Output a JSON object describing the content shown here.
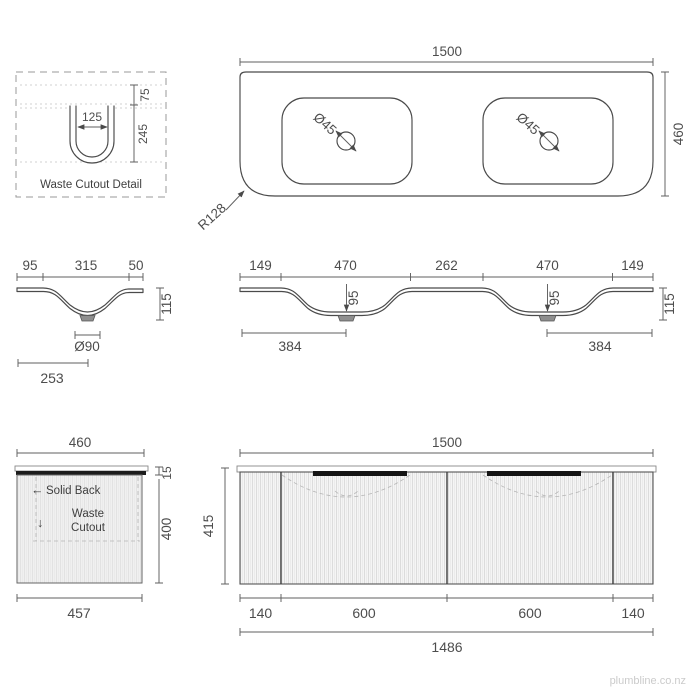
{
  "colors": {
    "line": "#4a4a4a",
    "text": "#4d4d4d",
    "handle": "#141414",
    "watermark": "#cbcbcb"
  },
  "watermark": "plumbline.co.nz",
  "waste_cutout_detail": {
    "title": "Waste Cutout Detail",
    "width": "125",
    "top_offset": "75",
    "depth": "245"
  },
  "benchtop_top_view": {
    "width": "1500",
    "depth": "460",
    "taphole_left": "Ø45",
    "taphole_right": "Ø45",
    "corner_radius": "R128"
  },
  "basin_side_section": {
    "back_offset": "95",
    "bowl_width": "315",
    "front_offset": "50",
    "height": "115",
    "drain_diameter": "Ø90",
    "drain_centre": "253"
  },
  "basin_front_section": {
    "dims": [
      "149",
      "470",
      "262",
      "470",
      "149"
    ],
    "bowl_depth_left": "95",
    "bowl_depth_right": "95",
    "height": "115",
    "drain_centre_left": "384",
    "drain_centre_right": "384"
  },
  "cabinet_side_view": {
    "width": "460",
    "top_thickness": "15",
    "height": "400",
    "bottom_width": "457",
    "back_arrow": "←",
    "back_note": "Solid Back",
    "waste_arrow": "↓",
    "waste_note_line1": "Waste",
    "waste_note_line2": "Cutout"
  },
  "cabinet_front_view": {
    "width": "1500",
    "height": "415",
    "dims": [
      "140",
      "600",
      "600",
      "140"
    ],
    "carcass_width": "1486"
  }
}
